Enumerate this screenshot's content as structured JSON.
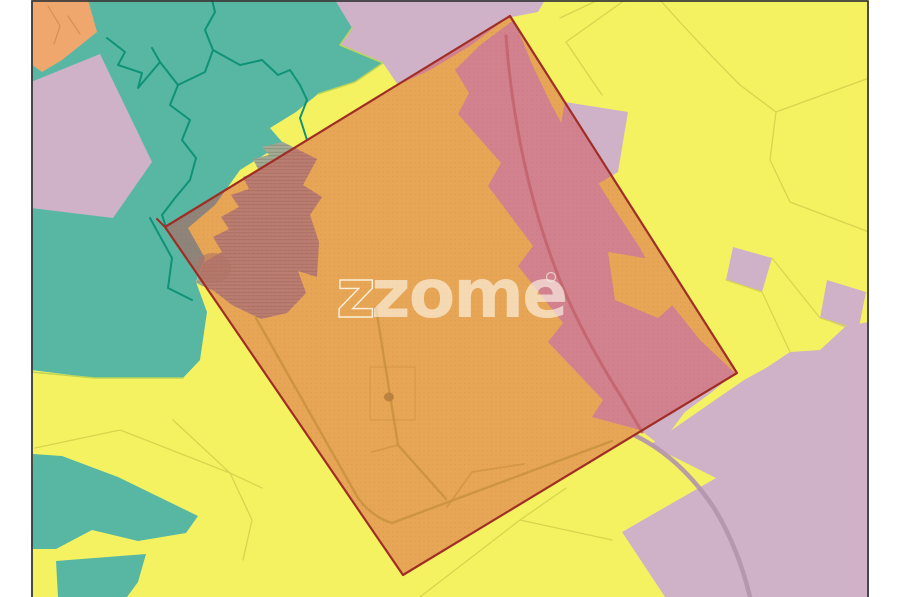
{
  "watermark": {
    "text": "zome",
    "outline_char": "z"
  },
  "map": {
    "palette": {
      "yellow": "#f5f262",
      "teal": "#58b7a3",
      "tealDark": "#0f9278",
      "tealEdge": "#bdd457",
      "orange": "#efa76e",
      "orangeLine": "#d98e4f",
      "lilac": "#cfb2c8",
      "lilacRoad": "#b492ac",
      "olive": "#d8d44e",
      "grey": "#a4aa94",
      "greyBlob": "#939a82",
      "overlayFill": "rgba(213,68,68,0.44)",
      "overlayEdge": "#9e2e26",
      "roadTan": "#c8903f",
      "roadTanDark": "#b5813c",
      "roadPink": "#c2636c",
      "frame": "#3a3a3a",
      "margin": "#ffffff",
      "watermark": "rgba(253,249,235,0.62)",
      "watermarkStroke": "rgba(253,249,235,0.88)"
    },
    "frame": {
      "left": 31,
      "top": 0,
      "right": 869,
      "bottom": 597
    },
    "overlay_square_points": "165,227 510,16 737,373 403,575",
    "layers": [
      {
        "name": "map-background",
        "type": "polygon",
        "points": "31,0 869,0 869,597 31,597",
        "fill": "yellow"
      },
      {
        "name": "lilac-region-top",
        "type": "polygon",
        "points": "332,0 545,0 538,12 507,18 470,46 430,70 398,85 383,63 340,45 352,28",
        "fill": "lilac"
      },
      {
        "name": "lilac-band-under-overlay",
        "type": "polygon",
        "points": "514,20 532,64 548,98 565,130 590,170 612,205 640,248 668,300 700,340 735,373 712,392 685,412 660,445 640,430 592,417 603,400 548,342 563,323 518,266 533,246 488,186 501,163 458,114 469,93 455,70 480,45",
        "fill": "lilac"
      },
      {
        "name": "lilac-parcel-east",
        "type": "polygon",
        "points": "565,102 628,112 618,172 588,190 558,140",
        "fill": "lilac"
      },
      {
        "name": "yellow-island-in-band",
        "type": "polygon",
        "points": "608,252 668,262 683,296 658,318 615,300",
        "fill": "yellow"
      },
      {
        "name": "teal-region-main",
        "type": "polygon",
        "points": "62,0 335,0 352,28 340,45 383,63 355,82 318,94 296,112 270,128 283,143 240,170 215,205 188,228 205,258 196,282 207,312 200,360 183,378 95,378 31,370 31,0",
        "fill": "teal"
      },
      {
        "name": "orange-region-corner",
        "type": "polygon",
        "points": "31,0 88,0 97,32 62,60 42,72 31,64",
        "fill": "orange"
      },
      {
        "name": "stream-line-orange",
        "type": "path",
        "d": "M48,6 L60,26 L54,44 M68,16 L80,34",
        "stroke": "orangeLine",
        "width": 1.2
      },
      {
        "name": "lilac-parcel-west",
        "type": "polygon",
        "points": "31,82 100,54 152,162 113,218 31,208",
        "fill": "lilac"
      },
      {
        "name": "teal-region-southwest",
        "type": "polygon",
        "points": "33,454 62,456 118,477 198,516 186,533 138,541 92,530 56,549 31,549",
        "fill": "teal"
      },
      {
        "name": "teal-parcel-south",
        "type": "polygon",
        "points": "56,561 146,554 138,582 127,597 58,597",
        "fill": "teal"
      },
      {
        "name": "lilac-region-southeast",
        "type": "polygon",
        "points": "869,322 846,326 820,350 790,352 766,368 744,380 650,445 716,478 622,532 665,597 869,597",
        "fill": "lilac"
      },
      {
        "name": "lilac-parcel-east-1",
        "type": "polygon",
        "points": "733,247 772,258 762,292 726,280",
        "fill": "lilac"
      },
      {
        "name": "lilac-parcel-east-2",
        "type": "polygon",
        "points": "827,280 866,292 858,332 820,318",
        "fill": "lilac"
      },
      {
        "name": "road-southeast",
        "type": "path",
        "d": "M636,436 C668,452 694,478 714,508 C730,534 742,564 750,597",
        "stroke": "lilacRoad",
        "width": 4.5,
        "opacity": 0.9
      },
      {
        "name": "stream-line-1",
        "type": "path",
        "d": "M107,38 L125,52 L118,65 L142,73 L138,88 L160,62 L152,48",
        "stroke": "tealDark",
        "width": 2
      },
      {
        "name": "stream-line-2",
        "type": "path",
        "d": "M160,62 L178,85 L170,105 L190,120 L182,140 L196,158 L190,180 L175,198 L162,215 L166,227",
        "stroke": "tealDark",
        "width": 2
      },
      {
        "name": "stream-line-3",
        "type": "path",
        "d": "M178,85 L205,72 L213,50 L205,30 L215,12 L212,0",
        "stroke": "tealDark",
        "width": 2
      },
      {
        "name": "stream-line-4",
        "type": "path",
        "d": "M213,50 L240,65 L262,60 L278,75 L290,70 L300,85 L307,100 L300,118 L307,140",
        "stroke": "tealDark",
        "width": 2
      },
      {
        "name": "stream-line-5",
        "type": "path",
        "d": "M150,218 L172,258 L168,288 L192,300",
        "stroke": "tealDark",
        "width": 2
      },
      {
        "name": "boundary-highlight-1",
        "type": "path",
        "d": "M352,28 L340,45 L383,63 L355,82 L318,94",
        "stroke": "tealEdge",
        "width": 1.5
      },
      {
        "name": "boundary-highlight-2",
        "type": "path",
        "d": "M31,372 L95,378 L183,378",
        "stroke": "tealEdge",
        "width": 1.5
      },
      {
        "name": "parcel-lines-southwest",
        "type": "path",
        "d": "M35,448 L120,430 L230,473 L262,488 M173,420 L230,473 M230,473 L252,520 L243,560",
        "stroke": "olive",
        "width": 1.3
      },
      {
        "name": "parcel-lines-south",
        "type": "path",
        "d": "M420,597 L520,520 L566,488 M520,520 L612,540",
        "stroke": "olive",
        "width": 1.3
      },
      {
        "name": "parcel-lines-east",
        "type": "path",
        "d": "M660,0 Q700,45 740,85 L776,112 M776,112 L869,78 M776,112 L770,160 L790,202 M790,202 L869,232 M598,0 L560,18 M625,0 L566,42 L602,95",
        "stroke": "olive",
        "width": 1.3
      },
      {
        "name": "parcel-lines-east-2",
        "type": "path",
        "d": "M726,280 L762,292 M772,258 L820,318 M762,292 L790,352 M820,318 L846,326",
        "stroke": "olive",
        "width": 1.2
      },
      {
        "name": "grey-zone",
        "type": "polygon",
        "points": "283,142 317,159 303,185 322,197 310,215 319,242 317,277 298,271 306,293 287,313 261,319 232,305 214,291 196,283 204,262 222,252 213,237 229,229 221,217 239,207 231,195 249,189 243,177 259,171 253,159 269,155 262,147",
        "fill": "grey"
      },
      {
        "name": "grey-zone-hatch",
        "type": "polygon",
        "points": "283,142 317,159 303,185 322,197 310,215 319,242 317,277 298,271 306,293 287,313 261,319 232,305 214,291 196,283 204,262 222,252 213,237 229,229 221,217 239,207 231,195 249,189 243,177 259,171 253,159 269,155 262,147",
        "fill": "url(#hatch)"
      },
      {
        "name": "grey-zone-blob",
        "type": "ellipse",
        "cx": 213,
        "cy": 268,
        "rx": 18,
        "ry": 15,
        "fill": "greyBlob",
        "opacity": 0.6
      },
      {
        "name": "overlay-square-fill",
        "type": "polygon",
        "points": "165,227 510,16 737,373 403,575",
        "fill": "overlayFill"
      },
      {
        "name": "overlay-square-texture",
        "type": "polygon",
        "points": "165,227 510,16 737,373 403,575",
        "fill": "url(#dots)"
      },
      {
        "name": "road-inside-1",
        "type": "path",
        "d": "M256,318 L358,498 Q372,517 392,523 L612,441",
        "stroke": "roadTan",
        "width": 2.4,
        "opacity": 0.85
      },
      {
        "name": "road-inside-2",
        "type": "path",
        "d": "M376,308 L398,445 L446,499",
        "stroke": "roadTan",
        "width": 2.4,
        "opacity": 0.85
      },
      {
        "name": "road-inside-3",
        "type": "path",
        "d": "M398,445 L372,452 M447,507 L472,472 L524,464",
        "stroke": "roadTan",
        "width": 1.8,
        "opacity": 0.6
      },
      {
        "name": "parcel-outline-inside",
        "type": "path",
        "d": "M370,367 L415,367 L415,420 L370,420 Z",
        "stroke": "roadTan",
        "width": 1.2,
        "opacity": 0.5
      },
      {
        "name": "building-mark",
        "type": "ellipse",
        "cx": 389,
        "cy": 397,
        "rx": 5,
        "ry": 4.5,
        "fill": "roadTanDark",
        "opacity": 0.9
      },
      {
        "name": "road-inside-pink",
        "type": "path",
        "d": "M506,36 C512,120 530,200 553,262 C570,310 598,360 622,398 L642,432",
        "stroke": "roadPink",
        "width": 3,
        "opacity": 0.85
      },
      {
        "name": "overlay-square-outline",
        "type": "polygon",
        "points": "165,227 510,16 737,373 403,575",
        "fill": "none",
        "stroke": "overlayEdge",
        "width": 2.2
      },
      {
        "name": "overlay-corner-tick",
        "type": "path",
        "d": "M165,227 L157,219",
        "stroke": "overlayEdge",
        "width": 2
      },
      {
        "name": "map-frame-border",
        "type": "path",
        "d": "M32,597 L32,1 L868,1 L868,597",
        "stroke": "frame",
        "width": 1.8
      }
    ]
  }
}
